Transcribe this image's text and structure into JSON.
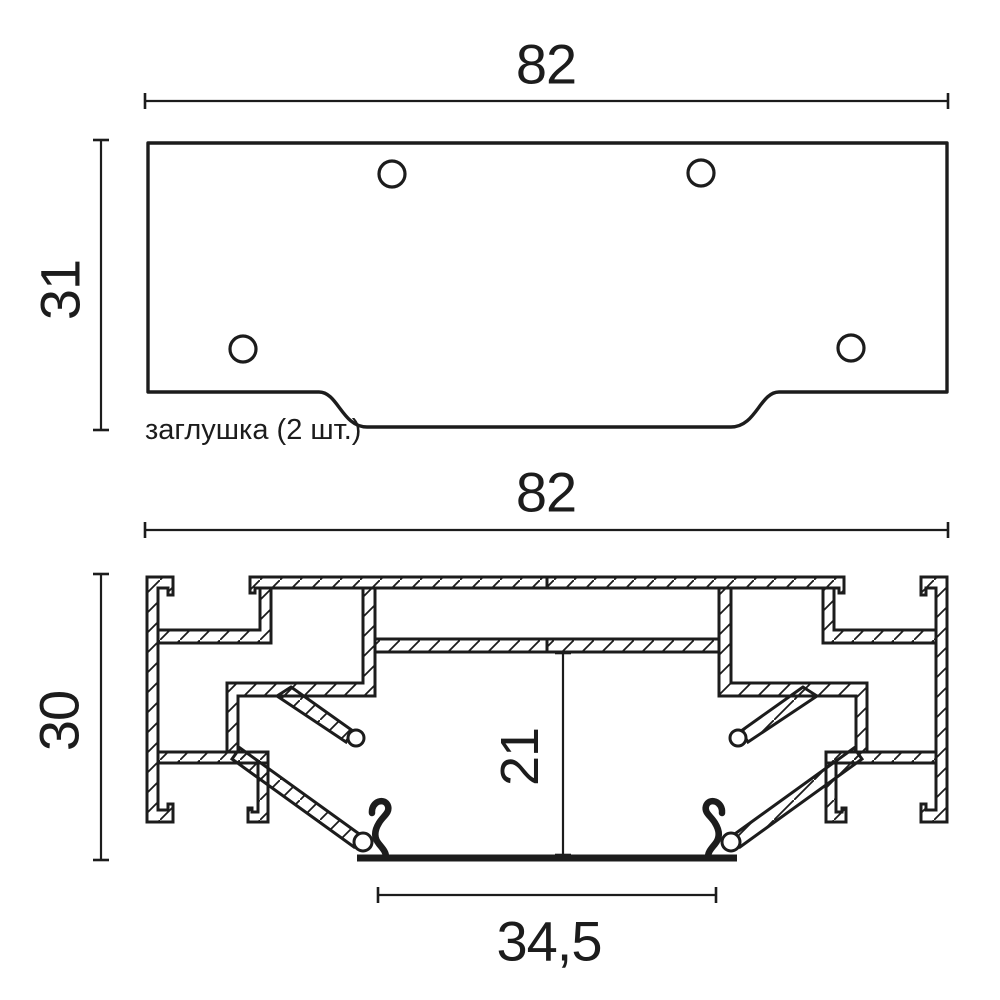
{
  "drawing": {
    "title": "profile-end-cap-technical-drawing",
    "colors": {
      "ink": "#1c1c1c",
      "background": "#ffffff"
    },
    "top_view": {
      "width_label": "82",
      "height_label": "31",
      "note_label": "заглушка (2 шт.)",
      "hole_count": 4
    },
    "section_view": {
      "width_label": "82",
      "height_label": "30",
      "inner_height_label": "21",
      "opening_width_label": "34,5"
    }
  }
}
